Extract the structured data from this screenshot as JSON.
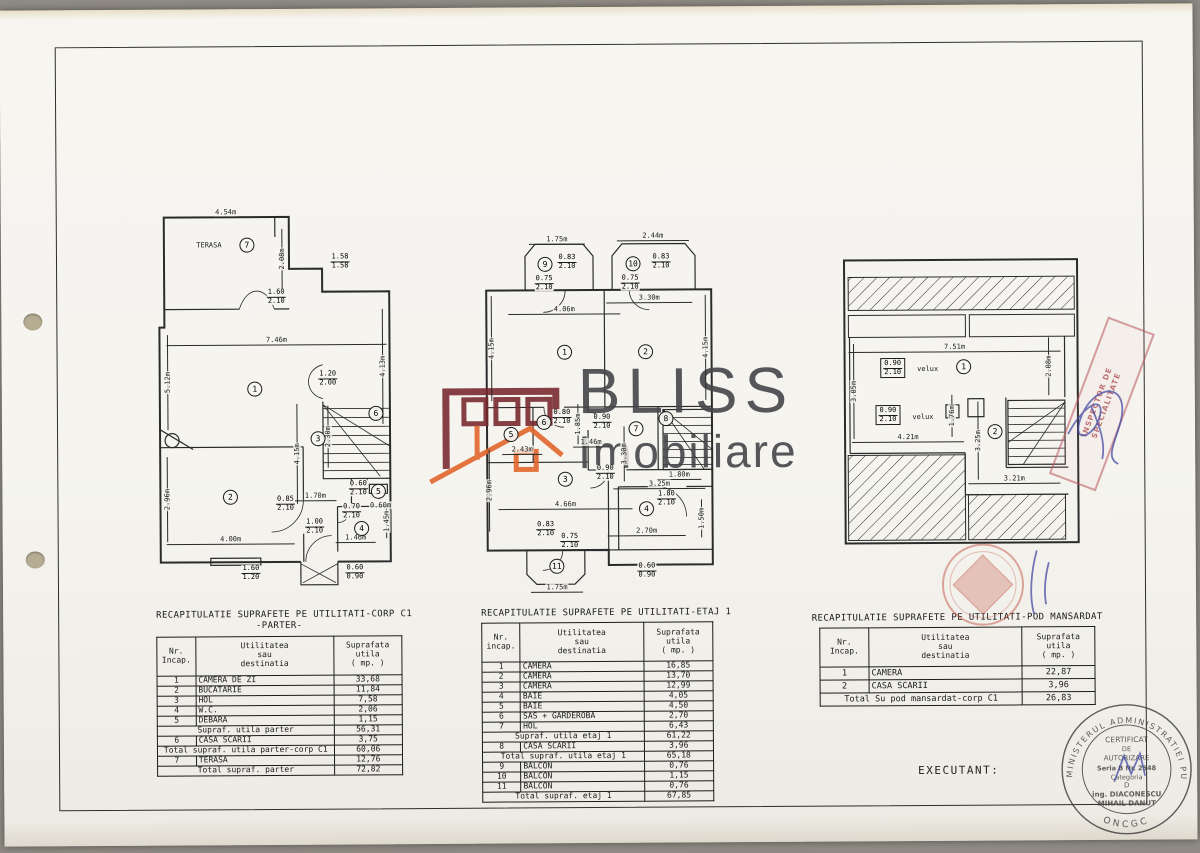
{
  "page": {
    "watermark_line1": "BLISS",
    "watermark_line2": "Imobiliare",
    "executant": "EXECUTANT:"
  },
  "plans": [
    {
      "name": "parter",
      "labels": [
        {
          "k": "t",
          "v": "4.54m",
          "x": 72,
          "y": 5,
          "dl": 118
        },
        {
          "k": "t",
          "v": "TERASA",
          "x": 55,
          "y": 38
        },
        {
          "k": "c",
          "v": "7",
          "x": 93,
          "y": 38
        },
        {
          "k": "t",
          "v": "2.08m",
          "x": 128,
          "y": 52,
          "r": -90,
          "dl": 60
        },
        {
          "k": "f",
          "v": [
            "1.58",
            "1.58"
          ],
          "x": 186,
          "y": 55
        },
        {
          "k": "f",
          "v": [
            "1.60",
            "2.10"
          ],
          "x": 122,
          "y": 90
        },
        {
          "k": "t",
          "v": "7.46m",
          "x": 122,
          "y": 133,
          "dl": 220
        },
        {
          "k": "t",
          "v": "5.12m",
          "x": 13,
          "y": 175,
          "r": -90,
          "dl": 95
        },
        {
          "k": "t",
          "v": "4.13m",
          "x": 228,
          "y": 160,
          "r": -90,
          "dl": 115
        },
        {
          "k": "c",
          "v": "1",
          "x": 100,
          "y": 182
        },
        {
          "k": "f",
          "v": [
            "1.20",
            "2.00"
          ],
          "x": 173,
          "y": 172
        },
        {
          "k": "c",
          "v": "6",
          "x": 221,
          "y": 207
        },
        {
          "k": "t",
          "v": "2.30m",
          "x": 173,
          "y": 230,
          "r": -90,
          "dl": 62
        },
        {
          "k": "t",
          "v": "4.15m",
          "x": 142,
          "y": 247,
          "r": -90,
          "dl": 100
        },
        {
          "k": "c",
          "v": "3",
          "x": 163,
          "y": 232
        },
        {
          "k": "f",
          "v": [
            "0.85",
            "2.10"
          ],
          "x": 130,
          "y": 297
        },
        {
          "k": "c",
          "v": "2",
          "x": 75,
          "y": 290
        },
        {
          "k": "t",
          "v": "2.96m",
          "x": 12,
          "y": 292,
          "r": -90,
          "dl": 85
        },
        {
          "k": "t",
          "v": "4.00m",
          "x": 75,
          "y": 332,
          "dl": 128
        },
        {
          "k": "f",
          "v": [
            "0.60",
            "2.10"
          ],
          "x": 203,
          "y": 282
        },
        {
          "k": "c",
          "v": "5",
          "x": 223,
          "y": 285
        },
        {
          "k": "t",
          "v": "0.60m",
          "x": 225,
          "y": 299
        },
        {
          "k": "f",
          "v": [
            "0.70",
            "2.10"
          ],
          "x": 196,
          "y": 305
        },
        {
          "k": "t",
          "v": "1.45m",
          "x": 231,
          "y": 315,
          "r": -90,
          "dl": 34
        },
        {
          "k": "c",
          "v": "4",
          "x": 206,
          "y": 322
        },
        {
          "k": "t",
          "v": "1.46m",
          "x": 200,
          "y": 331,
          "dl": 40
        },
        {
          "k": "t",
          "v": "1.70m",
          "x": 160,
          "y": 289,
          "dl": 42
        },
        {
          "k": "f",
          "v": [
            "1.00",
            "2.10"
          ],
          "x": 159,
          "y": 320
        },
        {
          "k": "f",
          "v": [
            "1.60",
            "1.20"
          ],
          "x": 95,
          "y": 366
        },
        {
          "k": "f",
          "v": [
            "0.60",
            "0.90"
          ],
          "x": 199,
          "y": 366
        }
      ]
    },
    {
      "name": "etaj-1",
      "labels": [
        {
          "k": "t",
          "v": "1.75m",
          "x": 80,
          "y": 7,
          "dl": 56
        },
        {
          "k": "c",
          "v": "9",
          "x": 68,
          "y": 32
        },
        {
          "k": "f",
          "v": [
            "0.83",
            "2.10"
          ],
          "x": 90,
          "y": 30
        },
        {
          "k": "f",
          "v": [
            "0.75",
            "2.10"
          ],
          "x": 67,
          "y": 51
        },
        {
          "k": "t",
          "v": "2.44m",
          "x": 176,
          "y": 4,
          "dl": 72
        },
        {
          "k": "c",
          "v": "10",
          "x": 156,
          "y": 32
        },
        {
          "k": "f",
          "v": [
            "0.83",
            "2.10"
          ],
          "x": 184,
          "y": 30
        },
        {
          "k": "f",
          "v": [
            "0.75",
            "2.10"
          ],
          "x": 153,
          "y": 51
        },
        {
          "k": "t",
          "v": "4.06m",
          "x": 87,
          "y": 77,
          "dl": 112
        },
        {
          "k": "t",
          "v": "3.30m",
          "x": 172,
          "y": 66,
          "dl": 86
        },
        {
          "k": "t",
          "v": "4.15m",
          "x": 14,
          "y": 116,
          "r": -90,
          "dl": 105
        },
        {
          "k": "c",
          "v": "1",
          "x": 87,
          "y": 120
        },
        {
          "k": "c",
          "v": "2",
          "x": 168,
          "y": 120
        },
        {
          "k": "t",
          "v": "4.15m",
          "x": 228,
          "y": 116,
          "r": -90,
          "dl": 105
        },
        {
          "k": "c",
          "v": "5",
          "x": 33,
          "y": 202
        },
        {
          "k": "t",
          "v": "2.43m",
          "x": 44,
          "y": 217,
          "dl": 40
        },
        {
          "k": "c",
          "v": "6",
          "x": 66,
          "y": 190
        },
        {
          "k": "f",
          "v": [
            "0.80",
            "2.10"
          ],
          "x": 84,
          "y": 185
        },
        {
          "k": "t",
          "v": "1.85m",
          "x": 100,
          "y": 192,
          "r": -90,
          "dl": 40
        },
        {
          "k": "f",
          "v": [
            "0.90",
            "2.10"
          ],
          "x": 124,
          "y": 190
        },
        {
          "k": "t",
          "v": "1.46m",
          "x": 113,
          "y": 210,
          "dl": 36
        },
        {
          "k": "c",
          "v": "7",
          "x": 158,
          "y": 197
        },
        {
          "k": "t",
          "v": "3.30m",
          "x": 146,
          "y": 222,
          "r": -90,
          "dl": 55
        },
        {
          "k": "c",
          "v": "8",
          "x": 188,
          "y": 187
        },
        {
          "k": "f",
          "v": [
            "0.90",
            "2.10"
          ],
          "x": 127,
          "y": 241
        },
        {
          "k": "t",
          "v": "1.80m",
          "x": 201,
          "y": 243,
          "dl": 44
        },
        {
          "k": "t",
          "v": "3.25m",
          "x": 181,
          "y": 252,
          "dl": 92
        },
        {
          "k": "c",
          "v": "3",
          "x": 87,
          "y": 247
        },
        {
          "k": "t",
          "v": "2.96m",
          "x": 11,
          "y": 258,
          "r": -90,
          "dl": 82
        },
        {
          "k": "t",
          "v": "4.66m",
          "x": 87,
          "y": 272,
          "dl": 134
        },
        {
          "k": "c",
          "v": "4",
          "x": 168,
          "y": 277
        },
        {
          "k": "f",
          "v": [
            "1.80",
            "2.10"
          ],
          "x": 188,
          "y": 267
        },
        {
          "k": "t",
          "v": "1.50m",
          "x": 223,
          "y": 287,
          "r": -90,
          "dl": 38
        },
        {
          "k": "t",
          "v": "2.70m",
          "x": 168,
          "y": 299,
          "dl": 78
        },
        {
          "k": "f",
          "v": [
            "0.83",
            "2.10"
          ],
          "x": 67,
          "y": 297
        },
        {
          "k": "f",
          "v": [
            "0.75",
            "2.10"
          ],
          "x": 91,
          "y": 309
        },
        {
          "k": "c",
          "v": "11",
          "x": 78,
          "y": 334
        },
        {
          "k": "t",
          "v": "1.75m",
          "x": 78,
          "y": 355,
          "dl": 52
        },
        {
          "k": "f",
          "v": [
            "0.60",
            "0.90"
          ],
          "x": 168,
          "y": 339
        }
      ]
    },
    {
      "name": "pod-mansardat",
      "labels": [
        {
          "k": "t",
          "v": "7.51m",
          "x": 117,
          "y": 94,
          "dl": 212
        },
        {
          "k": "t",
          "v": "2.08m",
          "x": 211,
          "y": 114,
          "r": -90,
          "dl": 58
        },
        {
          "k": "t",
          "v": "3.05m",
          "x": 16,
          "y": 138,
          "r": -90,
          "dl": 95
        },
        {
          "k": "b",
          "v": [
            "0.90",
            "2.10"
          ],
          "x": 55,
          "y": 115
        },
        {
          "k": "t",
          "v": "velux",
          "x": 90,
          "y": 116
        },
        {
          "k": "c",
          "v": "1",
          "x": 126,
          "y": 114
        },
        {
          "k": "b",
          "v": [
            "0.90",
            "2.10"
          ],
          "x": 50,
          "y": 162
        },
        {
          "k": "t",
          "v": "velux",
          "x": 85,
          "y": 164
        },
        {
          "k": "t",
          "v": "4.21m",
          "x": 70,
          "y": 184,
          "dl": 112
        },
        {
          "k": "t",
          "v": "1.76m",
          "x": 114,
          "y": 163,
          "r": -90,
          "dl": 42
        },
        {
          "k": "t",
          "v": "3.25m",
          "x": 140,
          "y": 188,
          "r": -90,
          "dl": 78
        },
        {
          "k": "c",
          "v": "2",
          "x": 157,
          "y": 179
        },
        {
          "k": "t",
          "v": "3.21m",
          "x": 176,
          "y": 226,
          "dl": 92
        }
      ]
    }
  ],
  "tables": [
    {
      "title_lines": [
        "RECAPITULATIE SUPRAFETE PE UTILITATI-CORP C1",
        "-PARTER-"
      ],
      "headers": [
        [
          "Nr.",
          "Incap."
        ],
        [
          "Utilitatea",
          "sau",
          "destinatia"
        ],
        [
          "Suprafata",
          "utila",
          "( mp. )"
        ]
      ],
      "rows": [
        {
          "nr": "1",
          "label": "CAMERA DE ZI",
          "value": "33,68"
        },
        {
          "nr": "2",
          "label": "BUCATARIE",
          "value": "11,84"
        },
        {
          "nr": "3",
          "label": "HOL",
          "value": "7,58"
        },
        {
          "nr": "4",
          "label": "W.C.",
          "value": "2,06"
        },
        {
          "nr": "5",
          "label": "DEBARA",
          "value": "1,15"
        },
        {
          "span": true,
          "label": "Supraf. utila parter",
          "value": "56,31"
        },
        {
          "nr": "6",
          "label": "CASA SCARII",
          "value": "3,75"
        },
        {
          "span": true,
          "label": "Total supraf. utila parter-corp C1",
          "value": "60,06"
        },
        {
          "nr": "7",
          "label": "TERASA",
          "value": "12,76"
        },
        {
          "span": true,
          "label": "Total supraf. parter",
          "value": "72,82"
        }
      ]
    },
    {
      "title_lines": [
        "RECAPITULATIE SUPRAFETE PE UTILITATI-ETAJ 1"
      ],
      "headers": [
        [
          "Nr.",
          "incap."
        ],
        [
          "Utilitatea",
          "sau",
          "destinatia"
        ],
        [
          "Suprafata",
          "utila",
          "( mp. )"
        ]
      ],
      "rows": [
        {
          "nr": "1",
          "label": "CAMERA",
          "value": "16,85"
        },
        {
          "nr": "2",
          "label": "CAMERA",
          "value": "13,70"
        },
        {
          "nr": "3",
          "label": "CAMERA",
          "value": "12,99"
        },
        {
          "nr": "4",
          "label": "BAIE",
          "value": "4,05"
        },
        {
          "nr": "5",
          "label": "BAIE",
          "value": "4,50"
        },
        {
          "nr": "6",
          "label": "SAS + GARDEROBA",
          "value": "2,70"
        },
        {
          "nr": "7",
          "label": "HOL",
          "value": "6,43"
        },
        {
          "span": true,
          "label": "Supraf. utila etaj 1",
          "value": "61,22"
        },
        {
          "nr": "8",
          "label": "CASA SCARII",
          "value": "3,96"
        },
        {
          "span": true,
          "label": "Total supraf. utila etaj 1",
          "value": "65,18"
        },
        {
          "nr": "9",
          "label": "BALCON",
          "value": "0,76"
        },
        {
          "nr": "10",
          "label": "BALCON",
          "value": "1,15"
        },
        {
          "nr": "11",
          "label": "BALCON",
          "value": "0,76"
        },
        {
          "span": true,
          "label": "Total supraf. etaj 1",
          "value": "67,85"
        }
      ]
    },
    {
      "title_lines": [
        "RECAPITULATIE SUPRAFETE PE UTILITATI-POD MANSARDAT"
      ],
      "headers": [
        [
          "Nr.",
          "Incap."
        ],
        [
          "Utilitatea",
          "sau",
          "destinatia"
        ],
        [
          "Suprafata",
          "utila",
          "( mp. )"
        ]
      ],
      "rows": [
        {
          "nr": "1",
          "label": "CAMERA",
          "value": "22,87"
        },
        {
          "nr": "2",
          "label": "CASA SCARII",
          "value": "3,96"
        },
        {
          "span": true,
          "label": "Total Su pod mansardat-corp C1",
          "value": "26,83"
        }
      ]
    }
  ],
  "stamps": {
    "inspector_lines": [
      "INSPECTOR DE",
      "SPECIALITATE"
    ],
    "certificate": {
      "ring_text": "MINISTERUL ADMINISTRATIEI PUBLICE",
      "ring_bottom": "ONCGC",
      "lines": [
        "CERTIFICAT",
        "DE",
        "AUTORIZARE",
        "Seria B Nr. 2548",
        "Categoria",
        "D",
        "ing. DIACONESCU",
        "MIHAIL DANUT"
      ]
    }
  }
}
